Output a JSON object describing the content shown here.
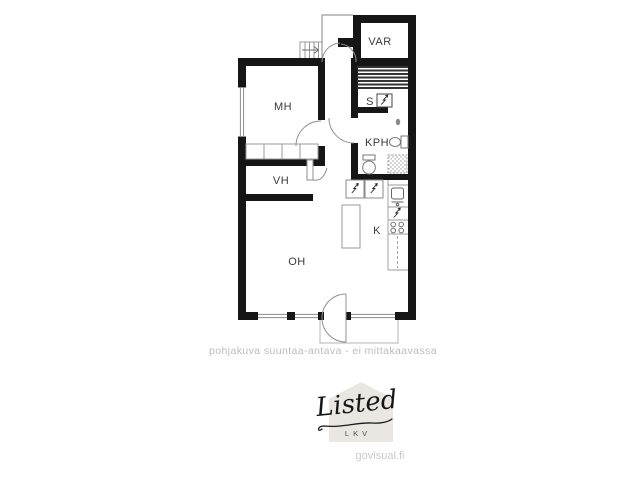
{
  "floorplan": {
    "caption": "pohjakuva suuntaa-antava - ei mittakaavassa",
    "rooms": [
      {
        "label": "MH"
      },
      {
        "label": "VH"
      },
      {
        "label": "OH"
      },
      {
        "label": "KPH"
      },
      {
        "label": "K"
      },
      {
        "label": "S"
      },
      {
        "label": "VAR"
      }
    ],
    "symbols": {
      "electric_appliance": "lightning-bolt-icon",
      "stair_direction": "arrow-right-icon"
    },
    "colors": {
      "wall": "#161616",
      "fixture_line": "#8f8f8f",
      "label": "#3a3a3a",
      "caption": "#bcbcbc"
    }
  },
  "branding": {
    "logo_text": "Listed",
    "logo_subtext": "LKV",
    "watermark": "govisual.fi",
    "colors": {
      "logo_house": "#eae7e2",
      "watermark_text": "#c9c9c9"
    }
  }
}
